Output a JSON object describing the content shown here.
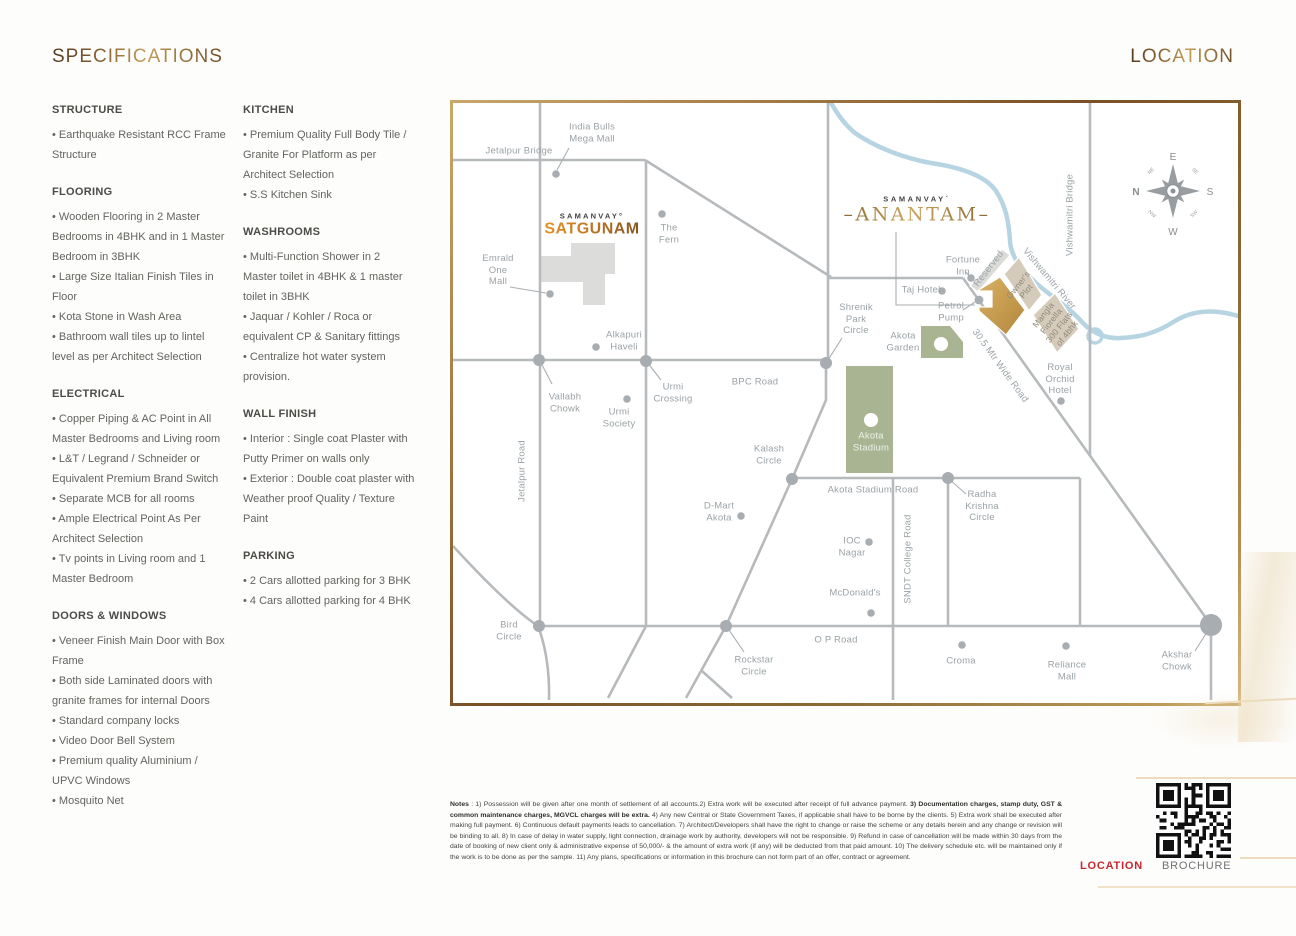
{
  "page": {
    "spec_title": "SPECIFICATIONS",
    "location_title": "LOCATION"
  },
  "specifications": {
    "columns": [
      [
        {
          "title": "STRUCTURE",
          "items": [
            "Earthquake Resistant RCC Frame Structure"
          ]
        },
        {
          "title": "FLOORING",
          "items": [
            "Wooden Flooring in 2 Master Bedrooms in  4BHK and in 1 Master Bedroom in 3BHK",
            "Large Size Italian Finish Tiles in Floor",
            "Kota Stone in Wash Area",
            "Bathroom wall tiles up to lintel level as per Architect Selection"
          ]
        },
        {
          "title": "ELECTRICAL",
          "items": [
            "Copper Piping & AC Point in All Master Bedrooms and Living room",
            "L&T / Legrand / Schneider or Equivalent Premium Brand Switch",
            "Separate MCB for all rooms",
            "Ample Electrical Point As Per Architect Selection",
            "Tv points in Living room and 1 Master Bedroom"
          ]
        },
        {
          "title": "DOORS & WINDOWS",
          "items": [
            "Veneer Finish Main Door with Box Frame",
            "Both side Laminated doors with granite frames for internal Doors",
            "Standard company locks",
            "Video Door Bell System",
            "Premium quality Aluminium / UPVC  Windows",
            "Mosquito Net"
          ]
        }
      ],
      [
        {
          "title": "KITCHEN",
          "items": [
            "Premium Quality Full Body Tile / Granite For Platform as per Architect Selection",
            "S.S Kitchen Sink"
          ]
        },
        {
          "title": "WASHROOMS",
          "items": [
            "Multi-Function Shower in 2 Master toilet in 4BHK & 1 master toilet in 3BHK",
            "Jaquar / Kohler / Roca or equivalent CP & Sanitary fittings",
            "Centralize hot water system provision."
          ]
        },
        {
          "title": "WALL FINISH",
          "items": [
            "Interior : Single coat Plaster with Putty Primer on walls only",
            "Exterior : Double coat plaster with Weather proof Quality  / Texture Paint"
          ]
        },
        {
          "title": "PARKING",
          "items": [
            "2 Cars allotted parking for 3 BHK",
            "4 Cars allotted parking for 4 BHK"
          ]
        }
      ]
    ]
  },
  "map": {
    "logos": {
      "satgunam_brand": "SAMANVAY°",
      "satgunam_name": "SATGUNAM",
      "anantam_brand": "SAMANVAY´",
      "anantam_name": "–ANANTAM–"
    },
    "compass": {
      "e": "E",
      "s": "S",
      "w": "W",
      "n": "N",
      "ne": "NE",
      "se": "SE",
      "sw": "SW",
      "nw": "NW"
    },
    "pois": [
      {
        "id": "india-bulls-mega-mall",
        "t": "India Bulls\nMega Mall",
        "x": 139,
        "y": 30
      },
      {
        "id": "jetalpur-bridge",
        "t": "Jetalpur Bridge",
        "x": 66,
        "y": 48
      },
      {
        "id": "the-fern",
        "t": "The\nFern",
        "x": 216,
        "y": 131
      },
      {
        "id": "emrald-one-mall",
        "t": "Emrald\nOne\nMall",
        "x": 45,
        "y": 167
      },
      {
        "id": "alkapuri-haveli",
        "t": "Alkapuri\nHaveli",
        "x": 171,
        "y": 238
      },
      {
        "id": "vallabh-chowk",
        "t": "Vallabh\nChowk",
        "x": 112,
        "y": 300
      },
      {
        "id": "urmi-society",
        "t": "Urmi\nSociety",
        "x": 166,
        "y": 315
      },
      {
        "id": "urmi-crossing",
        "t": "Urmi\nCrossing",
        "x": 220,
        "y": 290
      },
      {
        "id": "bpc-road",
        "t": "BPC Road",
        "x": 302,
        "y": 279
      },
      {
        "id": "jetalpur-road",
        "t": "Jetalpur Road",
        "x": 69,
        "y": 368,
        "r": -90
      },
      {
        "id": "bird-circle",
        "t": "Bird\nCircle",
        "x": 56,
        "y": 528
      },
      {
        "id": "kalash-circle",
        "t": "Kalash\nCircle",
        "x": 316,
        "y": 352
      },
      {
        "id": "d-mart-akota",
        "t": "D-Mart\nAkota",
        "x": 266,
        "y": 409
      },
      {
        "id": "akota-stadium-road",
        "t": "Akota Stadium Road",
        "x": 420,
        "y": 387
      },
      {
        "id": "ioc-nagar",
        "t": "IOC\nNagar",
        "x": 399,
        "y": 444
      },
      {
        "id": "sndt-college-road",
        "t": "SNDT College Road",
        "x": 455,
        "y": 456,
        "r": -90
      },
      {
        "id": "mcdonalds",
        "t": "McDonald's",
        "x": 402,
        "y": 490
      },
      {
        "id": "radha-krishna-circle",
        "t": "Radha\nKrishna\nCircle",
        "x": 529,
        "y": 403
      },
      {
        "id": "op-road",
        "t": "O P Road",
        "x": 383,
        "y": 537
      },
      {
        "id": "rockstar-circle",
        "t": "Rockstar\nCircle",
        "x": 301,
        "y": 563
      },
      {
        "id": "croma",
        "t": "Croma",
        "x": 508,
        "y": 558
      },
      {
        "id": "reliance-mall",
        "t": "Reliance\nMall",
        "x": 614,
        "y": 568
      },
      {
        "id": "akshar-chowk",
        "t": "Akshar\nChowk",
        "x": 724,
        "y": 558
      },
      {
        "id": "taj-hotel",
        "t": "Taj Hotel",
        "x": 468,
        "y": 187
      },
      {
        "id": "fortune-inn",
        "t": "Fortune\nInn",
        "x": 510,
        "y": 163
      },
      {
        "id": "petrol-pump",
        "t": "Petrol\nPump",
        "x": 498,
        "y": 209
      },
      {
        "id": "shrenik-park-circle",
        "t": "Shrenik\nPark\nCircle",
        "x": 403,
        "y": 216
      },
      {
        "id": "akota-garden",
        "t": "Akota\nGarden",
        "x": 450,
        "y": 239
      },
      {
        "id": "akota-stadium",
        "t": "Akota\nStadium",
        "x": 418,
        "y": 339,
        "c": "white"
      },
      {
        "id": "royal-orchid-hotel",
        "t": "Royal\nOrchid\nHotel",
        "x": 607,
        "y": 276
      },
      {
        "id": "reserved-plot",
        "t": "Reserved",
        "x": 536,
        "y": 166,
        "r": -52
      },
      {
        "id": "owners-plot",
        "t": "Owner's\nPlot",
        "x": 569,
        "y": 185,
        "r": -52,
        "c": "plot"
      },
      {
        "id": "mangla-fiorella",
        "t": "Mangla\nFiorella\n300 Flats\nof 4bhk",
        "x": 602,
        "y": 221,
        "r": -52,
        "c": "plot"
      },
      {
        "id": "vishwamitri-river",
        "t": "Vishwamitri River",
        "x": 596,
        "y": 176,
        "r": 50
      },
      {
        "id": "vishwamitri-bridge",
        "t": "Vishwamitri Bridge",
        "x": 617,
        "y": 112,
        "r": -90
      },
      {
        "id": "road-30-5-mtr",
        "t": "30.5 Mtr Wide Road",
        "x": 547,
        "y": 263,
        "r": 54
      }
    ]
  },
  "notes": {
    "label": "Notes",
    "part1": " : 1) Possession will be given after one month of settlement of all accounts.2) Extra work will be executed after receipt of full advance payment. ",
    "part2_bold": "3) Documentation charges, stamp duty, GST & common maintenance charges, MGVCL charges will be extra.",
    "part3": " 4) Any new Central or State Government Taxes, if applicable shall have to be borne by the clients. 5) Extra work shall be executed after making full payment. 6) Continuous default payments leads to cancellation. 7) Architect/Developers shall have the right to change or raise the scheme or any details herein and any change or revision will be binding to all. 8) In case of delay in water supply, light connection, drainage work by authority, developers will not be responsible. 9) Refund in case of cancellation will be made within 30 days from the date of booking of new client only & administrative expense of 50,000/- & the amount of extra work (if any) will be deducted from that paid amount. 10) The delivery schedule etc. will be maintained only if the work is to be done as per the sample. 11) Any plans, specifications or information in this brochure can not form part of an offer, contract or agreement."
  },
  "footer": {
    "location_label": "LOCATION",
    "brochure_label": "BROCHURE"
  }
}
